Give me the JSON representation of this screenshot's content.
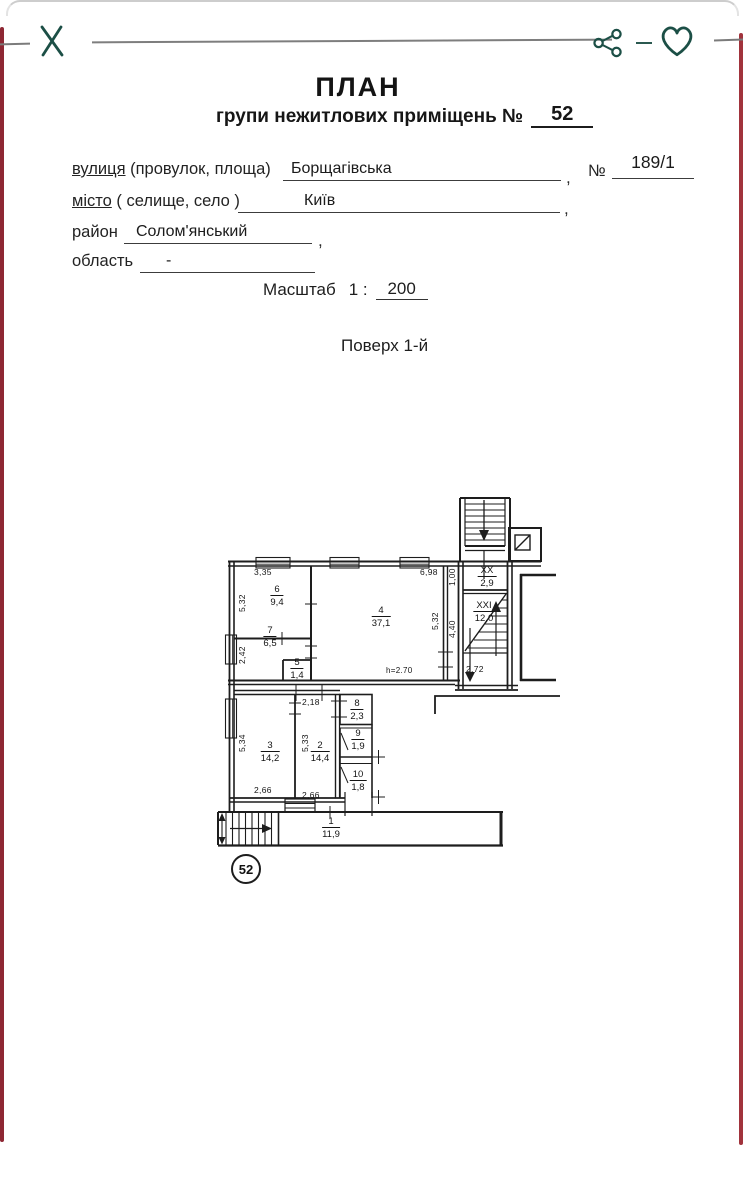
{
  "toolbar": {
    "close_icon": "close",
    "share_icon": "share",
    "favorite_icon": "favorite"
  },
  "header": {
    "title": "ПЛАН",
    "subtitle_prefix": "групи нежитлових приміщень №",
    "subtitle_value": "52"
  },
  "fields": {
    "street_label": "вулиця",
    "street_label_suffix": " (провулок, площа)",
    "street_value": "Борщагівська",
    "street_comma": ",",
    "number_label": "№",
    "number_value": "189/1",
    "city_label": "місто",
    "city_label_suffix": " ( селище, село )",
    "city_value": "Київ",
    "city_comma": ",",
    "district_label": "район",
    "district_value": "Солом'янський",
    "district_comma": ",",
    "region_label": "область",
    "region_value": "-"
  },
  "scale": {
    "label": "Масштаб",
    "ratio_prefix": "1 :",
    "ratio_value": "200"
  },
  "floor": {
    "label": "Поверх 1-й"
  },
  "plan": {
    "unit_badge": "52",
    "rooms": [
      {
        "num": "6",
        "area": "9,4"
      },
      {
        "num": "7",
        "area": "6,5"
      },
      {
        "num": "5",
        "area": "1,4"
      },
      {
        "num": "4",
        "area": "37,1"
      },
      {
        "num": "XX",
        "area": "2,9"
      },
      {
        "num": "XXI",
        "area": "12,0"
      },
      {
        "num": "8",
        "area": "2,3"
      },
      {
        "num": "9",
        "area": "1,9"
      },
      {
        "num": "10",
        "area": "1,8"
      },
      {
        "num": "3",
        "area": "14,2"
      },
      {
        "num": "2",
        "area": "14,4"
      },
      {
        "num": "1",
        "area": "11,9"
      }
    ],
    "dims": [
      "3,35",
      "5,32",
      "6,98",
      "2,42",
      "5,32",
      "h=2.70",
      "1,00",
      "4,40",
      "2,72",
      "2,18",
      "5,33",
      "5,34",
      "2,66",
      "2,66"
    ]
  },
  "colors": {
    "accent_icons": "#1c4f46",
    "scan_edge_red": "#8e2733",
    "toolbar_line_gray": "#7e7e7e",
    "ink": "#1d1d1d"
  }
}
